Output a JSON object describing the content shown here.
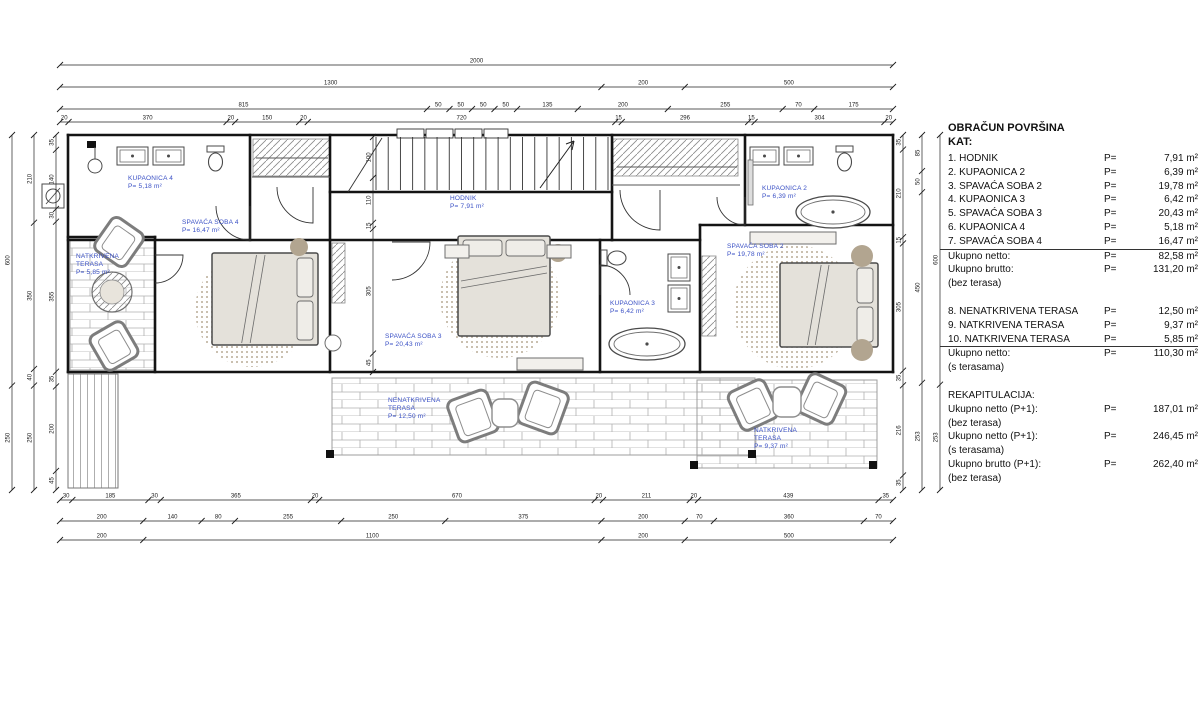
{
  "colors": {
    "wall": "#141414",
    "furniture": "#6e6e6e",
    "label_blue": "#3a50c5",
    "dim": "#1c1c1c",
    "tan": "#b2a590",
    "bed_fill": "#e4e1da"
  },
  "legend": {
    "title_line1": "OBRAČUN POVRŠINA",
    "title_line2": "KAT:",
    "rows": [
      {
        "label": "1. HODNIK",
        "p": "P=",
        "value": "7,91 m²"
      },
      {
        "label": "2. KUPAONICA 2",
        "p": "P=",
        "value": "6,39 m²"
      },
      {
        "label": "3. SPAVAĆA SOBA 2",
        "p": "P=",
        "value": "19,78 m²"
      },
      {
        "label": "4. KUPAONICA 3",
        "p": "P=",
        "value": "6,42 m²"
      },
      {
        "label": "5. SPAVAĆA SOBA 3",
        "p": "P=",
        "value": "20,43 m²"
      },
      {
        "label": "6. KUPAONICA 4",
        "p": "P=",
        "value": "5,18 m²"
      },
      {
        "label": "7. SPAVAĆA SOBA 4",
        "p": "P=",
        "value": "16,47 m²",
        "rule_after": true
      },
      {
        "label": "Ukupno netto:",
        "p": "P=",
        "value": "82,58 m²"
      },
      {
        "label": "Ukupno brutto:",
        "p": "P=",
        "value": "131,20 m²"
      },
      {
        "label": "(bez terasa)"
      },
      {
        "blank": true
      },
      {
        "label": "8. NENATKRIVENA TERASA",
        "p": "P=",
        "value": "12,50 m²"
      },
      {
        "label": "9. NATKRIVENA TERASA",
        "p": "P=",
        "value": "9,37 m²"
      },
      {
        "label": "10. NATKRIVENA TERASA",
        "p": "P=",
        "value": "5,85 m²",
        "rule_after": true
      },
      {
        "label": "Ukupno netto:",
        "p": "P=",
        "value": "110,30 m²"
      },
      {
        "label": "(s terasama)"
      },
      {
        "blank": true
      },
      {
        "label": "REKAPITULACIJA:"
      },
      {
        "label": "Ukupno netto (P+1):",
        "p": "P=",
        "value": "187,01 m²"
      },
      {
        "label": "(bez terasa)"
      },
      {
        "label": "Ukupno netto (P+1):",
        "p": "P=",
        "value": "246,45 m²"
      },
      {
        "label": "(s terasama)"
      },
      {
        "label": "Ukupno brutto (P+1):",
        "p": "P=",
        "value": "262,40 m²"
      },
      {
        "label": "(bez terasa)"
      }
    ]
  },
  "plan": {
    "bricks": [
      [
        70,
        239,
        85,
        131
      ],
      [
        332,
        378,
        423,
        77
      ],
      [
        697,
        380,
        180,
        88
      ]
    ],
    "vhatch": [
      68,
      374,
      50,
      114
    ],
    "rugs": [
      {
        "cx": 252,
        "cy": 310,
        "r": 57
      },
      {
        "cx": 500,
        "cy": 298,
        "r": 60
      },
      {
        "cx": 795,
        "cy": 307,
        "r": 62
      }
    ],
    "hatches": [
      [
        253,
        139,
        77,
        37
      ],
      [
        613,
        139,
        125,
        37
      ],
      [
        332,
        243,
        13,
        60
      ],
      [
        702,
        256,
        14,
        80
      ]
    ],
    "rods": [
      [
        256,
        158,
        328,
        158
      ],
      [
        617,
        167,
        737,
        167
      ]
    ],
    "walls": [
      [
        68,
        135,
        893,
        135
      ],
      [
        68,
        135,
        68,
        372
      ],
      [
        893,
        135,
        893,
        372
      ],
      [
        68,
        372,
        893,
        372
      ],
      [
        68,
        240,
        330,
        240
      ],
      [
        250,
        135,
        250,
        240
      ],
      [
        330,
        135,
        330,
        372
      ],
      [
        330,
        192,
        612,
        192
      ],
      [
        330,
        240,
        612,
        240
      ],
      [
        612,
        135,
        612,
        240
      ],
      [
        612,
        240,
        700,
        240
      ],
      [
        68,
        237,
        155,
        237
      ],
      [
        155,
        237,
        155,
        372
      ],
      [
        600,
        240,
        600,
        372
      ],
      [
        700,
        225,
        700,
        372
      ],
      [
        700,
        225,
        893,
        225
      ],
      [
        745,
        135,
        745,
        225
      ]
    ],
    "thin": [
      [
        252,
        177,
        330,
        177
      ],
      [
        612,
        185,
        740,
        185
      ]
    ],
    "windows": [
      [
        397,
        129,
        27,
        9
      ],
      [
        426,
        129,
        27,
        9
      ],
      [
        455,
        129,
        27,
        9
      ],
      [
        484,
        129,
        24,
        9
      ]
    ],
    "stairs": {
      "x1": 376,
      "x2": 608,
      "y1": 137,
      "y2": 190,
      "count": 20,
      "brk": [
        348,
        192,
        382,
        138
      ],
      "arrow": [
        540,
        188,
        574,
        141
      ]
    },
    "beds": [
      {
        "x": 212,
        "y": 253,
        "w": 106,
        "h": 92,
        "pillow": "right"
      },
      {
        "x": 458,
        "y": 236,
        "w": 92,
        "h": 100,
        "pillow": "top"
      },
      {
        "x": 780,
        "y": 263,
        "w": 98,
        "h": 84,
        "pillow": "right"
      }
    ],
    "chairs": [
      {
        "x": 100,
        "y": 222,
        "w": 38,
        "h": 40,
        "rot": 35
      },
      {
        "x": 95,
        "y": 326,
        "w": 38,
        "h": 40,
        "rot": -30
      },
      {
        "x": 452,
        "y": 394,
        "w": 42,
        "h": 44,
        "rot": -20
      },
      {
        "x": 522,
        "y": 386,
        "w": 42,
        "h": 44,
        "rot": 20
      },
      {
        "x": 733,
        "y": 384,
        "w": 40,
        "h": 42,
        "rot": -25
      },
      {
        "x": 801,
        "y": 378,
        "w": 40,
        "h": 42,
        "rot": 25
      }
    ],
    "round_tables": [
      {
        "cx": 112,
        "cy": 292,
        "r": 20,
        "ir": 12
      }
    ],
    "square_tables": [
      [
        492,
        399,
        26,
        28
      ],
      [
        773,
        387,
        28,
        30
      ]
    ],
    "tubs": [
      {
        "cx": 833,
        "cy": 212,
        "rx": 37,
        "ry": 16
      },
      {
        "cx": 647,
        "cy": 344,
        "rx": 38,
        "ry": 16
      }
    ],
    "toilets": [
      {
        "x": 207,
        "y": 146,
        "w": 17,
        "h": 26,
        "rot": 0
      },
      {
        "x": 836,
        "y": 146,
        "w": 17,
        "h": 26,
        "rot": 0
      },
      {
        "x": 601,
        "y": 250,
        "w": 26,
        "h": 16,
        "rot": 1
      }
    ],
    "sinks": [
      [
        117,
        147,
        31,
        18
      ],
      [
        153,
        147,
        31,
        18
      ],
      [
        750,
        147,
        29,
        18
      ],
      [
        784,
        147,
        29,
        18
      ],
      [
        668,
        254,
        22,
        27
      ],
      [
        668,
        285,
        22,
        27
      ]
    ],
    "dots": [
      [
        299,
        247,
        9
      ],
      [
        558,
        253,
        9
      ],
      [
        862,
        256,
        11
      ],
      [
        862,
        350,
        11
      ]
    ],
    "shelves": [
      [
        445,
        245,
        24,
        13
      ],
      [
        547,
        245,
        24,
        13
      ],
      [
        750,
        232,
        86,
        12
      ],
      [
        517,
        358,
        66,
        12
      ]
    ],
    "posts": [
      [
        87,
        141,
        9,
        7
      ],
      [
        326,
        450,
        8,
        8
      ],
      [
        748,
        450,
        8,
        8
      ],
      [
        690,
        461,
        8,
        8
      ],
      [
        869,
        461,
        8,
        8
      ]
    ],
    "lamp": {
      "cx": 95,
      "cy": 166,
      "r": 7,
      "x1": 95,
      "y1": 147,
      "x2": 95,
      "y2": 159
    },
    "vent": {
      "x": 42,
      "y": 184,
      "w": 22,
      "h": 24
    },
    "stool": {
      "cx": 333,
      "cy": 343,
      "r": 8
    },
    "radiator": {
      "x": 748,
      "y": 160,
      "w": 5,
      "h": 45
    },
    "doors": [
      {
        "hx": 250,
        "hy": 206,
        "r": 34,
        "a1": 90,
        "a2": 180
      },
      {
        "hx": 313,
        "hy": 187,
        "r": 36,
        "a1": 90,
        "a2": 180
      },
      {
        "hx": 392,
        "hy": 242,
        "r": 38,
        "a1": 0,
        "a2": 90
      },
      {
        "hx": 660,
        "hy": 190,
        "r": 40,
        "a1": 90,
        "a2": 180
      },
      {
        "hx": 600,
        "hy": 295,
        "r": 30,
        "a1": 270,
        "a2": 360
      },
      {
        "hx": 155,
        "hy": 255,
        "r": 28,
        "a1": 0,
        "a2": 90
      },
      {
        "hx": 745,
        "hy": 197,
        "r": 28,
        "a1": 90,
        "a2": 180
      }
    ],
    "labels": [
      {
        "x": 128,
        "y": 180,
        "lines": [
          "KUPAONICA 4",
          "P= 5,18 m²"
        ]
      },
      {
        "x": 182,
        "y": 224,
        "lines": [
          "SPAVAĆA SOBA 4",
          "P= 16,47 m²"
        ]
      },
      {
        "x": 76,
        "y": 258,
        "lines": [
          "NATKRIVENA",
          "TERASA",
          "P= 5,85 m²"
        ]
      },
      {
        "x": 450,
        "y": 200,
        "lines": [
          "HODNIK",
          "P= 7,91 m²"
        ]
      },
      {
        "x": 385,
        "y": 338,
        "lines": [
          "SPAVAĆA SOBA 3",
          "P= 20,43 m²"
        ]
      },
      {
        "x": 610,
        "y": 305,
        "lines": [
          "KUPAONICA 3",
          "P= 6,42 m²"
        ]
      },
      {
        "x": 727,
        "y": 248,
        "lines": [
          "SPAVAĆA SOBA 2",
          "P= 19,78 m²"
        ]
      },
      {
        "x": 762,
        "y": 190,
        "lines": [
          "KUPAONICA 2",
          "P= 6,39 m²"
        ]
      },
      {
        "x": 388,
        "y": 402,
        "lines": [
          "NENATKRIVENA",
          "TERASA",
          "P= 12,50 m²"
        ]
      },
      {
        "x": 754,
        "y": 432,
        "lines": [
          "NATKRIVENA",
          "TERASA",
          "P= 9,37 m²"
        ]
      }
    ],
    "dims_h": [
      {
        "y": 65,
        "x1": 60,
        "x2": 893,
        "parts": [
          "2000"
        ]
      },
      {
        "y": 87,
        "x1": 60,
        "x2": 893,
        "parts": [
          "1300",
          "200",
          "500"
        ]
      },
      {
        "y": 109,
        "x1": 60,
        "x2": 893,
        "parts": [
          "815",
          "50",
          "50",
          "50",
          "50",
          "135",
          "200",
          "255",
          "70",
          "175"
        ]
      },
      {
        "y": 122,
        "x1": 60,
        "x2": 893,
        "parts": [
          "20",
          "370",
          "20",
          "150",
          "20",
          "720",
          "15",
          "296",
          "15",
          "304",
          "20"
        ]
      },
      {
        "y": 500,
        "x1": 60,
        "x2": 893,
        "parts": [
          "30",
          "185",
          "30",
          "365",
          "20",
          "670",
          "20",
          "211",
          "20",
          "439",
          "35"
        ]
      },
      {
        "y": 521,
        "x1": 60,
        "x2": 893,
        "parts": [
          "200",
          "140",
          "80",
          "255",
          "250",
          "375",
          "200",
          "70",
          "360",
          "70"
        ]
      },
      {
        "y": 540,
        "x1": 60,
        "x2": 893,
        "parts": [
          "200",
          "1100",
          "200",
          "500"
        ]
      }
    ],
    "dims_v": [
      {
        "x": 12,
        "y1": 135,
        "y2": 490,
        "parts": [
          "600",
          "250"
        ]
      },
      {
        "x": 34,
        "y1": 135,
        "y2": 490,
        "parts": [
          "210",
          "350",
          "40",
          "250"
        ]
      },
      {
        "x": 56,
        "y1": 135,
        "y2": 490,
        "parts": [
          "35",
          "140",
          "30",
          "355",
          "35",
          "200",
          "45"
        ]
      },
      {
        "x": 373,
        "y1": 137,
        "y2": 372,
        "parts": [
          "100",
          "110",
          "15",
          "305",
          "45"
        ]
      },
      {
        "x": 903,
        "y1": 135,
        "y2": 490,
        "parts": [
          "35",
          "210",
          "15",
          "305",
          "35",
          "216",
          "35"
        ]
      },
      {
        "x": 922,
        "y1": 135,
        "y2": 490,
        "parts": [
          "85",
          "50",
          "450",
          "253"
        ]
      },
      {
        "x": 940,
        "y1": 135,
        "y2": 490,
        "parts": [
          "600",
          "253"
        ]
      }
    ]
  }
}
